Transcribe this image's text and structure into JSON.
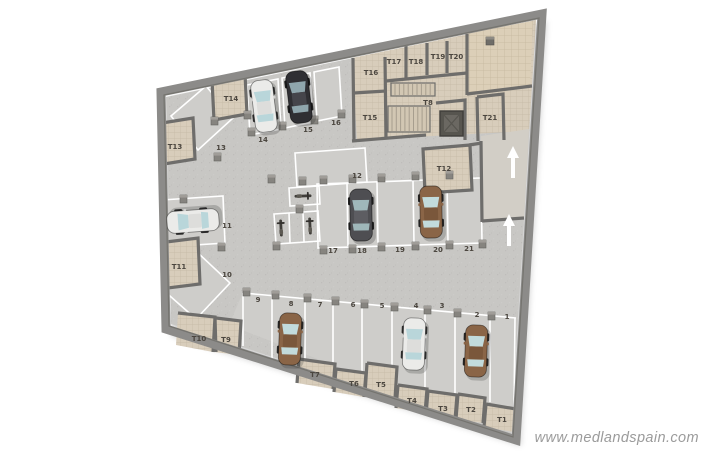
{
  "watermark": "www.medlandspain.com",
  "plan": {
    "type": "underground-parking-floor-plan",
    "parking_spaces": {
      "p1": "1",
      "p2": "2",
      "p3": "3",
      "p4": "4",
      "p5": "5",
      "p6": "6",
      "p7": "7",
      "p8": "8",
      "p9": "9",
      "p10": "10",
      "p11": "11",
      "p12": "12",
      "p13": "13",
      "p14": "14",
      "p15": "15",
      "p16": "16",
      "p17": "17",
      "p18": "18",
      "p19": "19",
      "p20": "20",
      "p21": "21"
    },
    "storage_rooms": {
      "t1": "T1",
      "t2": "T2",
      "t3": "T3",
      "t4": "T4",
      "t5": "T5",
      "t6": "T6",
      "t7": "T7",
      "t8": "T8",
      "t9": "T9",
      "t10": "T10",
      "t11": "T11",
      "t12": "T12",
      "t13": "T13",
      "t14": "T14",
      "t15": "T15",
      "t16": "T16",
      "t17": "T17",
      "t18": "T18",
      "t19": "T19",
      "t20": "T20",
      "t21": "T21"
    },
    "ramp_arrows": {
      "direction": "up",
      "count": 2
    },
    "vehicles": [
      {
        "space": "14",
        "color": "white"
      },
      {
        "space": "15",
        "color": "black"
      },
      {
        "space": "11",
        "color": "white"
      },
      {
        "space": "18",
        "color": "dark-gray"
      },
      {
        "space": "20",
        "color": "brown"
      },
      {
        "space": "8",
        "color": "brown"
      },
      {
        "space": "4",
        "color": "white"
      },
      {
        "space": "2",
        "color": "brown"
      },
      {
        "type": "motorcycles",
        "area": "center-left",
        "count": 3
      }
    ],
    "colors": {
      "background": "#ffffff",
      "outer_wall": "#8c8b89",
      "inner_wall": "#6e6d6b",
      "concrete_floor": "#c8c7c4",
      "parking_floor": "#cecdca",
      "storage_floor": "#d8cdbb",
      "terrace_floor": "#dccfb8",
      "parking_line": "#ffffff",
      "car_white": "#ebebe9",
      "car_black": "#2f2f33",
      "car_gray": "#4e4e52",
      "car_brown": "#8a6547",
      "glass": "#b9d6da",
      "arrow": "#ffffff",
      "label_text": "#4b463f",
      "watermark_text": "#9b9b9b"
    }
  }
}
